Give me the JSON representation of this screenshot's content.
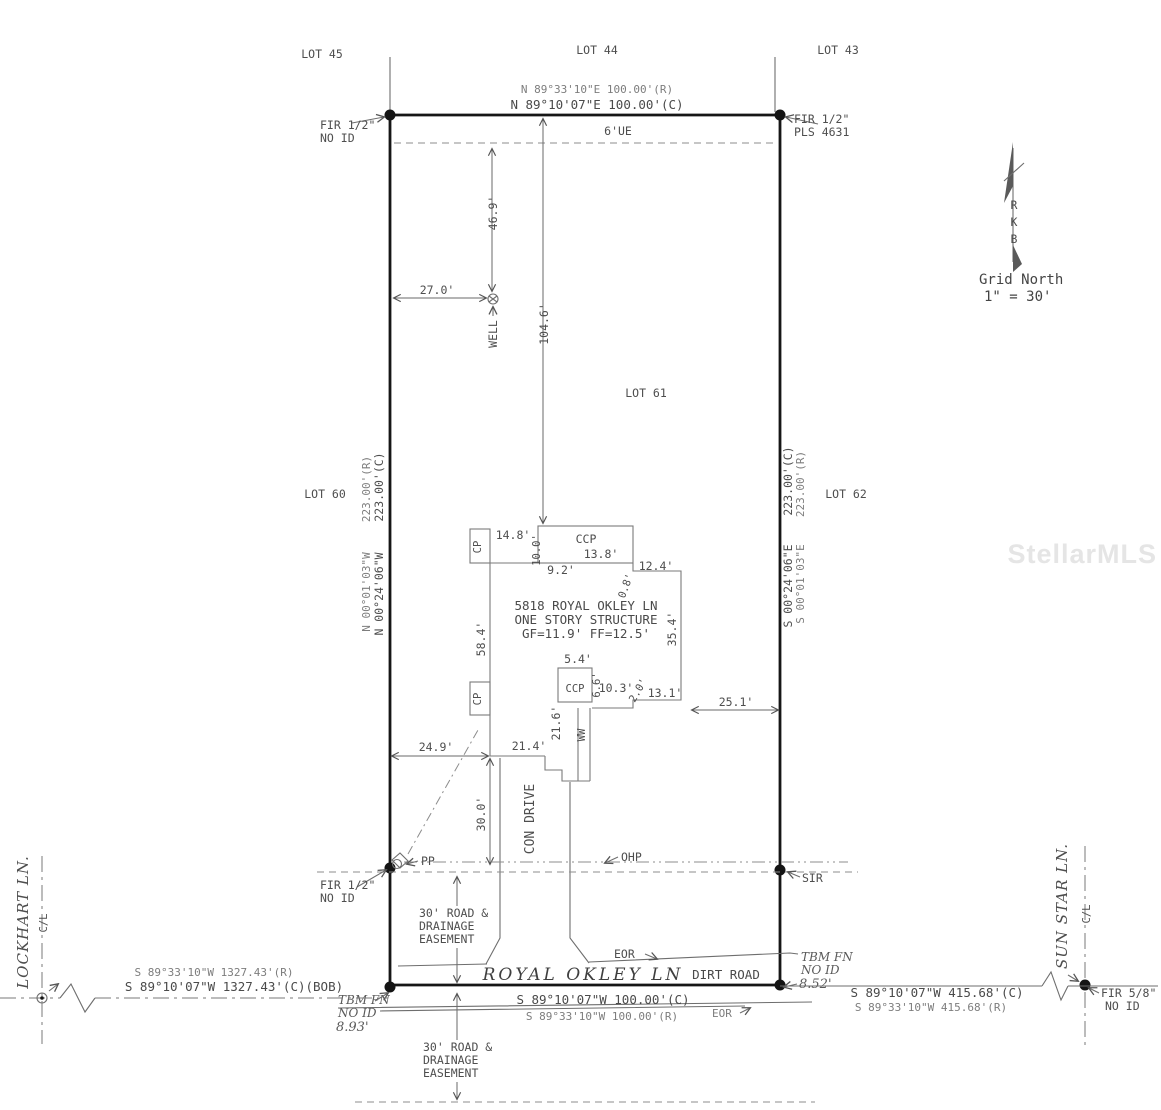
{
  "watermark": "StellarMLS",
  "lots": {
    "lot43": "LOT 43",
    "lot44": "LOT 44",
    "lot45": "LOT 45",
    "lot60": "LOT 60",
    "lot61": "LOT 61",
    "lot62": "LOT 62"
  },
  "north": {
    "label": "Grid North",
    "scale": "1\" = 30'",
    "i1": "R",
    "i2": "K",
    "i3": "B"
  },
  "north_line": {
    "record": "N 89°33'10\"E  100.00'(R)",
    "calc": "N 89°10'07\"E  100.00'(C)",
    "easement": "6'UE"
  },
  "west_line": {
    "rec_bearing": "N 00°01'03\"W",
    "rec_dist": "223.00'(R)",
    "calc_bearing": "N 00°24'06\"W",
    "calc_dist": "223.00'(C)"
  },
  "east_line": {
    "calc_bearing": "S 00°24'06\"E",
    "calc_dist": "223.00'(C)",
    "rec_bearing": "S 00°01'03\"E",
    "rec_dist": "223.00'(R)"
  },
  "south_line": {
    "calc": "S 89°10'07\"W  100.00'(C)",
    "record": "S 89°33'10\"W  100.00'(R)"
  },
  "west_road": {
    "record": "S 89°33'10\"W  1327.43'(R)",
    "calc": "S 89°10'07\"W  1327.43'(C)(BOB)"
  },
  "east_road": {
    "calc": "S 89°10'07\"W  415.68'(C)",
    "record": "S 89°33'10\"W  415.68'(R)"
  },
  "monuments": {
    "nw1": "FIR 1/2\"",
    "nw2": "NO ID",
    "ne1": "FIR 1/2\"",
    "ne2": "PLS 4631",
    "w1": "FIR 1/2\"",
    "w2": "NO ID",
    "sir": "SIR",
    "se1": "FIR 5/8\"",
    "se2": "NO ID",
    "tbm_sw1": "TBM FN",
    "tbm_sw2": "NO ID",
    "tbm_sw3": "8.93'",
    "tbm_se1": "TBM FN",
    "tbm_se2": "NO ID",
    "tbm_se3": "8.52'"
  },
  "building": {
    "address": "5818 ROYAL OKLEY LN",
    "type": "ONE STORY STRUCTURE",
    "floors": "GF=11.9'   FF=12.5'",
    "ccp": "CCP",
    "ccp2": "CCP",
    "cp1": "CP",
    "cp2": "CP",
    "ww": "WW",
    "well": "WELL",
    "drive": "CON DRIVE"
  },
  "dims": {
    "d27_0": "27.0'",
    "d46_9": "46.9'",
    "d104_6": "104.6'",
    "d14_8": "14.8'",
    "d10_0": "10.0'",
    "d13_8": "13.8'",
    "d9_2": "9.2'",
    "d0_8": "0.8'",
    "d12_4": "12.4'",
    "d58_4": "58.4'",
    "d35_4": "35.4'",
    "d5_4": "5.4'",
    "d6_6": "6.6'",
    "d10_3": "10.3'",
    "d2_0": "2.0'",
    "d13_1": "13.1'",
    "d25_1": "25.1'",
    "d21_6": "21.6'",
    "d21_4": "21.4'",
    "d24_9": "24.9'",
    "d30_0": "30.0'"
  },
  "utilities": {
    "pp": "PP",
    "ohp": "OHP",
    "eor1": "EOR",
    "eor2": "EOR"
  },
  "roads": {
    "royal_okley": "ROYAL OKLEY LN",
    "dirt": "DIRT ROAD",
    "lockhart": "LOCKHART LN.",
    "sun_star": "SUN STAR LN.",
    "cl_w": "C/L",
    "cl_e": "C/L"
  },
  "easement1": {
    "l1": "30' ROAD &",
    "l2": "DRAINAGE",
    "l3": "EASEMENT"
  },
  "easement2": {
    "l1": "30' ROAD &",
    "l2": "DRAINAGE",
    "l3": "EASEMENT"
  }
}
